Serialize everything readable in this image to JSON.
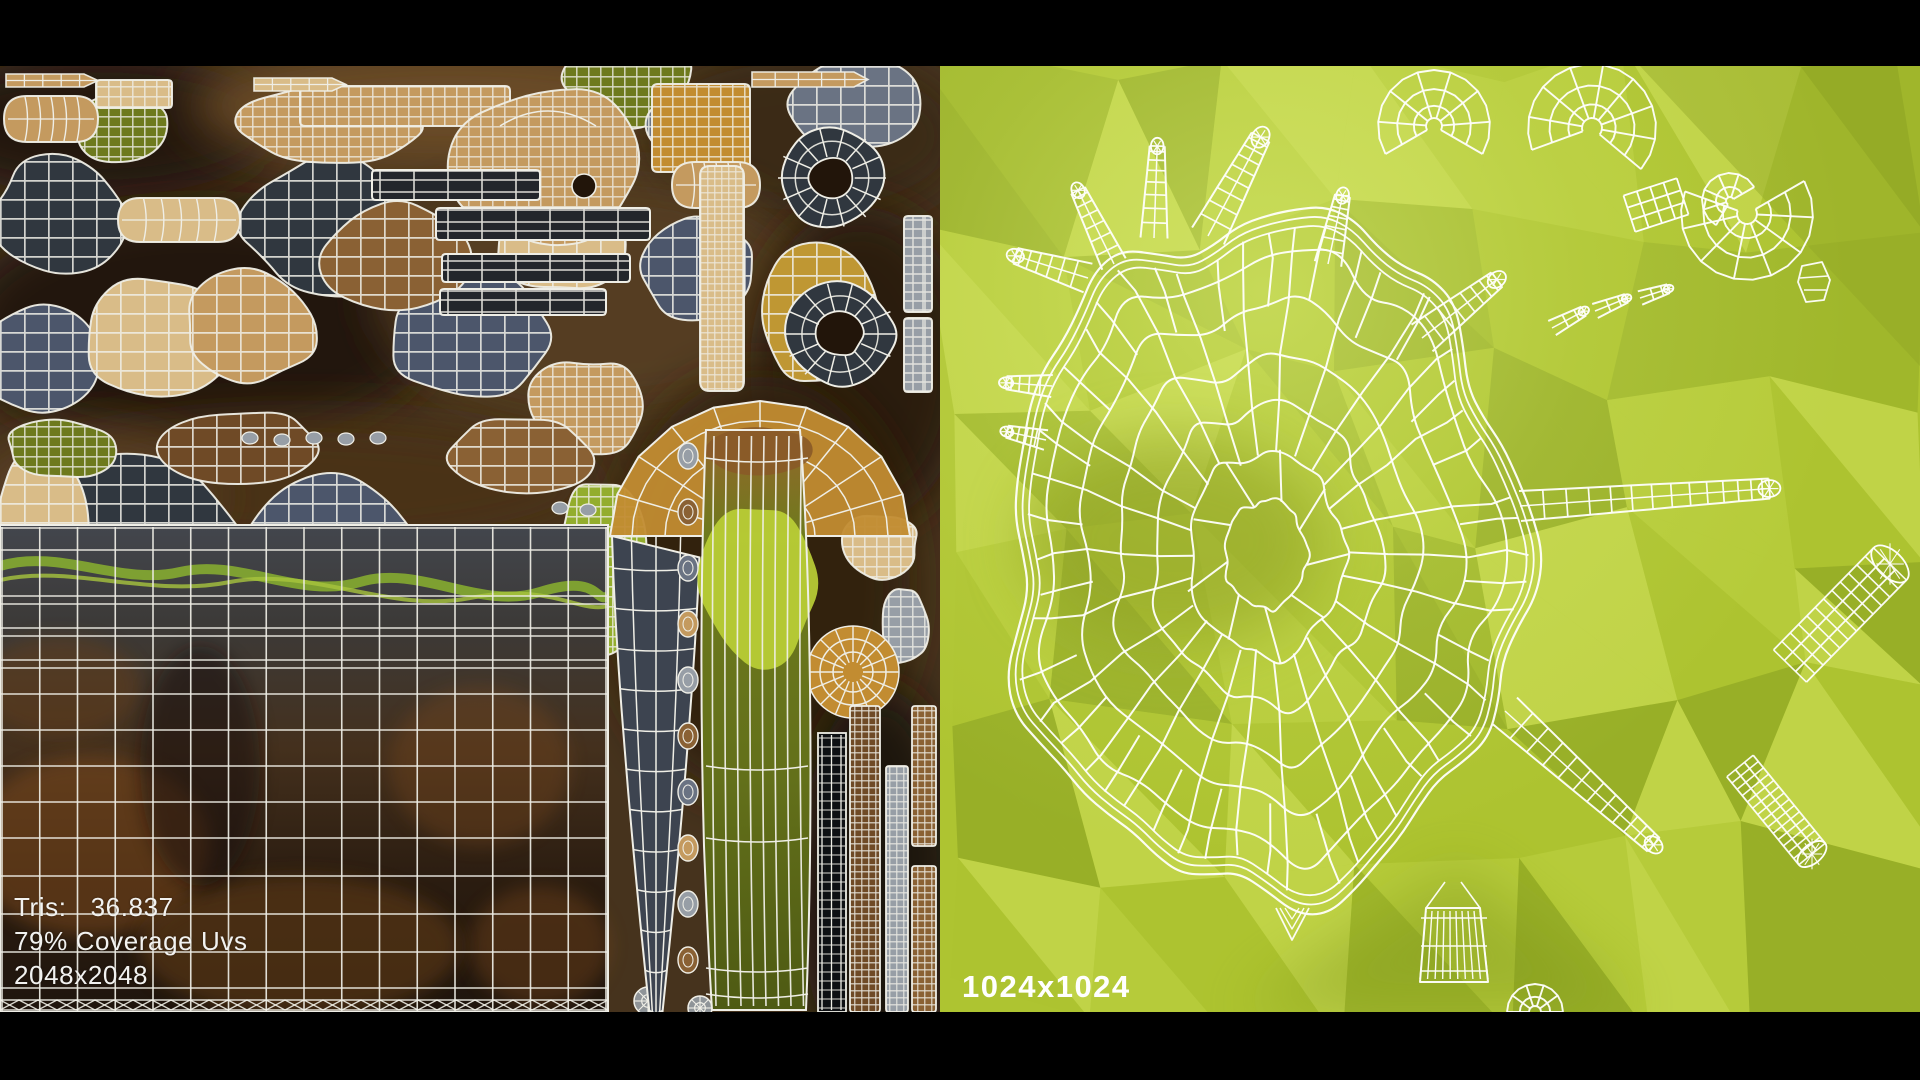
{
  "scene": {
    "description": "3D model UV layout presentation render",
    "letterbox_color": "#000000"
  },
  "left_panel": {
    "name": "uv-texture-atlas",
    "stats": {
      "tris_label": "Tris:",
      "tris_value": "36.837",
      "coverage": "79% Coverage Uvs",
      "resolution": "2048x2048"
    },
    "text_color": "#f2f2f0",
    "palette": {
      "background": "#46331d",
      "background_dark": "#22150a",
      "wire": "#efeee6",
      "tan": "#c49a5f",
      "tan_light": "#d9bc88",
      "gold": "#c28c31",
      "mustard": "#bf9733",
      "wood": "#8a6134",
      "brown": "#6f4a26",
      "slate": "#4c566b",
      "slate_dark": "#30373f",
      "slate_mid": "#6a7383",
      "gray": "#979ea6",
      "olive": "#6e7a1d",
      "moss": "#93ad2d",
      "moss_bright": "#bbcf36",
      "bar_dark": "#23262b",
      "blade": "#3d4450",
      "plate_top": "#43464d",
      "plate_mid": "#44301d",
      "plate_dark": "#1f150d",
      "rust": "#7b491c",
      "vine": "#8ab22f",
      "ladder_dark": "#0e1013"
    }
  },
  "right_panel": {
    "name": "wireframe-texture-preview",
    "resolution": "1024x1024",
    "text_color": "#ffffff",
    "palette": {
      "base": "#aec431",
      "facet_dark": "#91a825",
      "facet_darker": "#7f961d",
      "facet_light": "#c0d446",
      "facet_lighter": "#d6e663",
      "glow": "#dff080",
      "smudge": "#8d9f24",
      "wire": "#fefefa"
    }
  }
}
